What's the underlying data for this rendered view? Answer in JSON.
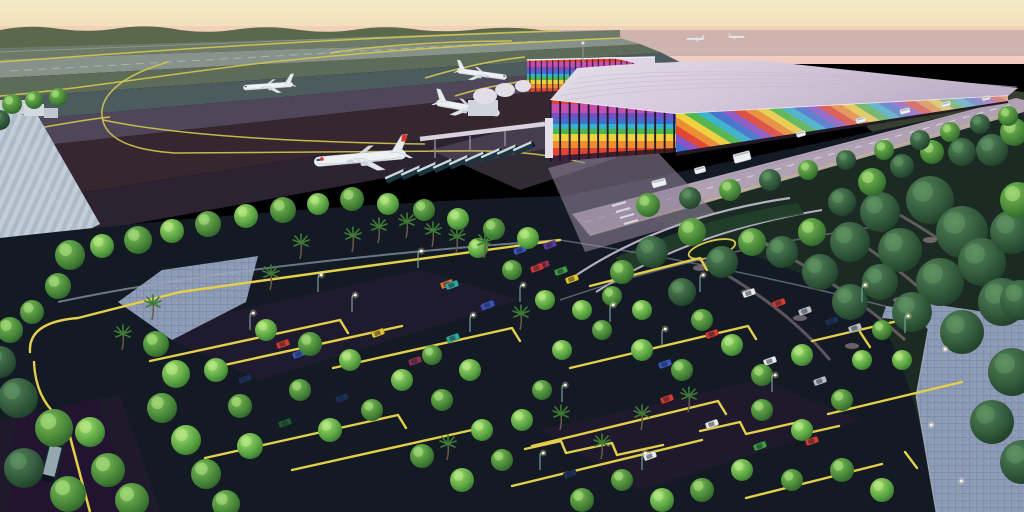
{
  "meta": {
    "title": "Aerial rendering of a tropical airport terminal at sunset",
    "description": "3D architectural rendering: rainbow-striped airport terminal with lavender roof, white jets on taxiways with yellow guide lines, bus queue, landscaped parking lot with yellow curbs, green trees, palm trees, street lamps and paver walkways under a peach sunset sky.",
    "type": "architectural-rendering"
  },
  "palette": {
    "sky_top": "#f2ecc6",
    "sky_mid": "#f6dcba",
    "sky_low": "#f0cbc2",
    "treeline": "#5a684c",
    "haze": "#9a8d9c",
    "tarmac_light": "#87928a",
    "tarmac_green": "#5d6b59",
    "tarmac_teal": "#4c5b5e",
    "tarmac_purple": "#4f4759",
    "tarmac_maroon": "#362630",
    "taxiline": "#d4c94f",
    "curb_yellow": "#e3cf4b",
    "roof": "#d6cbda",
    "roof_rib": "#c7bacd",
    "rainbow": [
      "#e04434",
      "#ee8c30",
      "#eed23c",
      "#4db648",
      "#35b2cc",
      "#3f6fd0",
      "#8a52c4",
      "#c44fb0"
    ],
    "road": "#b0a2b2",
    "asphalt": "#141a24",
    "paver": "#8e9bb6",
    "grass_island": "#21402a",
    "bus_body": "#1d3540",
    "plane_body": "#eef1f4"
  },
  "scene": {
    "taxiway_lines": [
      "M0,62 C160,50 340,38 560,31",
      "M0,96 C90,88 180,72 280,61 C380,51 480,44 620,38",
      "M168,62 C120,76 100,96 102,116 C104,138 130,150 175,153 L460,151 C520,150 555,156 585,163",
      "M103,120 C170,134 280,142 425,144",
      "M330,53 C380,45 450,41 512,41",
      "M425,78 C465,66 495,60 525,57",
      "M455,96 C480,88 505,84 530,80",
      "M0,135 C40,128 80,120 110,117"
    ],
    "parking_rows": [
      "M30,352 Q28,322 78,318 L180,292 L368,266",
      "M66,422 Q36,404 34,362",
      "M150,361 L340,320 l8,13",
      "M220,366 L402,326",
      "M333,368 L512,328 l8,13",
      "M205,458 L398,415 l8,13",
      "M292,470 L472,430",
      "M590,286 L700,258 l7,12",
      "M570,368 L748,326 l8,13",
      "M532,446 L718,401 l8,13",
      "M512,486 L702,440",
      "M812,341 L902,320",
      "M828,414 L962,382",
      "M746,498 L882,464",
      "M525,449 l36,-8 l5,12 l46,-10 l5,12 l46,-10",
      "M700,431 l40,-9 l6,12 l48,-11 l5,12 l40,-9",
      "M860,332 l10,15",
      "M905,452 l12,16",
      "M368,266 L560,240"
    ],
    "airplanes": [
      {
        "x": 268,
        "y": 86,
        "s": 0.62,
        "r": -4,
        "flip": false,
        "mark": false
      },
      {
        "x": 360,
        "y": 158,
        "s": 1.15,
        "r": -5,
        "flip": false,
        "mark": true
      },
      {
        "x": 468,
        "y": 108,
        "s": 0.8,
        "r": 10,
        "flip": true,
        "mark": false
      },
      {
        "x": 482,
        "y": 74,
        "s": 0.62,
        "r": 8,
        "flip": true,
        "mark": false
      },
      {
        "x": 695,
        "y": 39,
        "s": 0.22,
        "r": 0,
        "flip": false,
        "mark": false
      },
      {
        "x": 737,
        "y": 37,
        "s": 0.2,
        "r": 0,
        "flip": true,
        "mark": false
      }
    ],
    "terminal_buses": {
      "count": 9,
      "start_x": 396,
      "start_y": 176,
      "dx": 16,
      "dy": -3.5,
      "angle": -24
    },
    "road_vehicles": [
      {
        "x": 905,
        "y": 111,
        "w": 10,
        "h": 5
      },
      {
        "x": 946,
        "y": 104,
        "w": 9,
        "h": 4.5
      },
      {
        "x": 986,
        "y": 98,
        "w": 8,
        "h": 4
      },
      {
        "x": 861,
        "y": 120,
        "w": 10,
        "h": 5
      },
      {
        "x": 801,
        "y": 134,
        "w": 9,
        "h": 5
      },
      {
        "x": 742,
        "y": 157,
        "w": 17,
        "h": 9
      },
      {
        "x": 700,
        "y": 170,
        "w": 11,
        "h": 6
      },
      {
        "x": 659,
        "y": 183,
        "w": 14,
        "h": 7
      }
    ],
    "cars": [
      [
        283,
        344,
        "#d23b30"
      ],
      [
        299,
        354,
        "#3b55bd"
      ],
      [
        245,
        379,
        "#1c2f55"
      ],
      [
        378,
        333,
        "#e5c32e"
      ],
      [
        453,
        338,
        "#2fa8a0"
      ],
      [
        415,
        361,
        "#8e2f52"
      ],
      [
        285,
        423,
        "#1f5c33"
      ],
      [
        342,
        398,
        "#1c2f55"
      ],
      [
        447,
        284,
        "#d4762e"
      ],
      [
        487,
        306,
        "#5b3a9e"
      ],
      [
        520,
        250,
        "#3b55bd"
      ],
      [
        550,
        245,
        "#5b3a9e"
      ],
      [
        543,
        265,
        "#8e2f52"
      ],
      [
        561,
        271,
        "#3f9e3f"
      ],
      [
        572,
        279,
        "#e5c32e"
      ],
      [
        452,
        285,
        "#2fa8a0"
      ],
      [
        488,
        305,
        "#3b55bd"
      ],
      [
        749,
        293,
        "#e8eaec"
      ],
      [
        779,
        303,
        "#d23b30"
      ],
      [
        805,
        311,
        "#b9c0c8"
      ],
      [
        832,
        321,
        "#1c2f55"
      ],
      [
        855,
        328,
        "#b9c0c8"
      ],
      [
        712,
        334,
        "#d23b30"
      ],
      [
        665,
        364,
        "#3b55bd"
      ],
      [
        770,
        361,
        "#e8eaec"
      ],
      [
        820,
        381,
        "#b9c0c8"
      ],
      [
        667,
        399,
        "#d23b30"
      ],
      [
        712,
        424,
        "#e8eaec"
      ],
      [
        760,
        446,
        "#3f9e3f"
      ],
      [
        812,
        441,
        "#d23b30"
      ],
      [
        650,
        456,
        "#e8eaec"
      ],
      [
        570,
        474,
        "#1c2f55"
      ],
      [
        537,
        268,
        "#d23b30"
      ]
    ],
    "trees": [
      [
        70,
        255,
        15,
        2
      ],
      [
        102,
        246,
        12,
        1
      ],
      [
        138,
        240,
        14,
        2
      ],
      [
        172,
        231,
        12,
        1
      ],
      [
        208,
        224,
        13,
        2
      ],
      [
        246,
        216,
        12,
        1
      ],
      [
        283,
        210,
        13,
        2
      ],
      [
        318,
        204,
        11,
        1
      ],
      [
        352,
        199,
        12,
        2
      ],
      [
        388,
        204,
        11,
        1
      ],
      [
        424,
        210,
        11,
        2
      ],
      [
        458,
        219,
        11,
        1
      ],
      [
        494,
        229,
        11,
        2
      ],
      [
        528,
        238,
        11,
        1
      ],
      [
        58,
        286,
        13,
        2
      ],
      [
        32,
        312,
        12,
        2
      ],
      [
        18,
        398,
        20,
        3
      ],
      [
        54,
        428,
        19,
        2
      ],
      [
        24,
        468,
        20,
        3
      ],
      [
        68,
        494,
        18,
        2
      ],
      [
        108,
        470,
        17,
        2
      ],
      [
        90,
        432,
        15,
        1
      ],
      [
        132,
        500,
        17,
        2
      ],
      [
        0,
        362,
        16,
        3
      ],
      [
        10,
        330,
        13,
        2
      ],
      [
        156,
        344,
        13,
        2
      ],
      [
        176,
        374,
        14,
        1
      ],
      [
        162,
        408,
        15,
        2
      ],
      [
        186,
        440,
        15,
        1
      ],
      [
        206,
        474,
        15,
        2
      ],
      [
        226,
        504,
        14,
        2
      ],
      [
        250,
        446,
        13,
        1
      ],
      [
        240,
        406,
        12,
        2
      ],
      [
        216,
        370,
        12,
        1
      ],
      [
        266,
        330,
        11,
        1
      ],
      [
        310,
        344,
        12,
        2
      ],
      [
        350,
        360,
        11,
        1
      ],
      [
        300,
        390,
        11,
        2
      ],
      [
        330,
        430,
        12,
        1
      ],
      [
        372,
        410,
        11,
        2
      ],
      [
        402,
        380,
        11,
        1
      ],
      [
        432,
        355,
        10,
        2
      ],
      [
        470,
        370,
        11,
        1
      ],
      [
        442,
        400,
        11,
        2
      ],
      [
        482,
        430,
        11,
        1
      ],
      [
        422,
        456,
        12,
        2
      ],
      [
        462,
        480,
        12,
        1
      ],
      [
        502,
        460,
        11,
        2
      ],
      [
        522,
        420,
        11,
        1
      ],
      [
        542,
        390,
        10,
        2
      ],
      [
        562,
        350,
        10,
        1
      ],
      [
        602,
        330,
        10,
        2
      ],
      [
        642,
        350,
        11,
        1
      ],
      [
        682,
        370,
        11,
        2
      ],
      [
        642,
        310,
        10,
        1
      ],
      [
        612,
        296,
        10,
        2
      ],
      [
        582,
        310,
        10,
        1
      ],
      [
        702,
        320,
        11,
        2
      ],
      [
        732,
        345,
        11,
        1
      ],
      [
        762,
        375,
        11,
        2
      ],
      [
        802,
        355,
        11,
        1
      ],
      [
        762,
        410,
        11,
        2
      ],
      [
        802,
        430,
        11,
        1
      ],
      [
        842,
        400,
        11,
        2
      ],
      [
        862,
        360,
        10,
        1
      ],
      [
        882,
        330,
        10,
        2
      ],
      [
        902,
        360,
        10,
        1
      ],
      [
        842,
        470,
        12,
        2
      ],
      [
        882,
        490,
        12,
        1
      ],
      [
        792,
        480,
        11,
        2
      ],
      [
        742,
        470,
        11,
        1
      ],
      [
        702,
        490,
        12,
        2
      ],
      [
        662,
        500,
        12,
        1
      ],
      [
        622,
        480,
        11,
        2
      ],
      [
        582,
        500,
        12,
        2
      ],
      [
        545,
        300,
        10,
        1
      ],
      [
        512,
        270,
        10,
        2
      ],
      [
        478,
        248,
        10,
        1
      ],
      [
        930,
        200,
        24,
        3
      ],
      [
        962,
        232,
        26,
        3
      ],
      [
        900,
        250,
        22,
        3
      ],
      [
        940,
        282,
        24,
        3
      ],
      [
        982,
        262,
        24,
        3
      ],
      [
        1012,
        232,
        22,
        3
      ],
      [
        1002,
        302,
        24,
        3
      ],
      [
        962,
        332,
        22,
        3
      ],
      [
        1012,
        372,
        24,
        3
      ],
      [
        992,
        422,
        22,
        3
      ],
      [
        1022,
        462,
        22,
        3
      ],
      [
        880,
        212,
        20,
        3
      ],
      [
        850,
        242,
        20,
        3
      ],
      [
        820,
        272,
        18,
        3
      ],
      [
        850,
        302,
        18,
        3
      ],
      [
        880,
        282,
        18,
        3
      ],
      [
        912,
        312,
        20,
        3
      ],
      [
        652,
        252,
        16,
        3
      ],
      [
        692,
        232,
        14,
        2
      ],
      [
        722,
        262,
        16,
        3
      ],
      [
        752,
        242,
        14,
        2
      ],
      [
        782,
        252,
        16,
        3
      ],
      [
        812,
        232,
        14,
        2
      ],
      [
        842,
        202,
        14,
        3
      ],
      [
        872,
        182,
        14,
        2
      ],
      [
        902,
        166,
        12,
        3
      ],
      [
        932,
        152,
        12,
        2
      ],
      [
        962,
        152,
        14,
        3
      ],
      [
        992,
        150,
        16,
        3
      ],
      [
        1014,
        132,
        14,
        2
      ],
      [
        682,
        292,
        14,
        3
      ],
      [
        622,
        272,
        12,
        2
      ],
      [
        1018,
        200,
        18,
        2
      ],
      [
        1020,
        300,
        20,
        3
      ],
      [
        12,
        104,
        10,
        2
      ],
      [
        34,
        100,
        9,
        2
      ],
      [
        58,
        97,
        9,
        2
      ],
      [
        0,
        120,
        10,
        3
      ],
      [
        648,
        205,
        12,
        2
      ],
      [
        690,
        198,
        11,
        3
      ],
      [
        730,
        190,
        11,
        2
      ],
      [
        770,
        180,
        11,
        3
      ],
      [
        808,
        170,
        10,
        2
      ],
      [
        846,
        160,
        10,
        3
      ],
      [
        884,
        150,
        10,
        2
      ],
      [
        920,
        140,
        10,
        3
      ],
      [
        950,
        132,
        10,
        2
      ],
      [
        980,
        124,
        10,
        3
      ],
      [
        1008,
        116,
        10,
        2
      ]
    ],
    "palms": [
      [
        378,
        243
      ],
      [
        406,
        238
      ],
      [
        432,
        247
      ],
      [
        352,
        252
      ],
      [
        456,
        253
      ],
      [
        484,
        258
      ],
      [
        300,
        259
      ],
      [
        152,
        320
      ],
      [
        122,
        350
      ],
      [
        641,
        430
      ],
      [
        601,
        459
      ],
      [
        447,
        460
      ],
      [
        520,
        330
      ],
      [
        560,
        430
      ],
      [
        688,
        412
      ],
      [
        270,
        290
      ]
    ],
    "lamps": [
      [
        318,
        292
      ],
      [
        418,
        268
      ],
      [
        520,
        302
      ],
      [
        610,
        322
      ],
      [
        700,
        292
      ],
      [
        662,
        346
      ],
      [
        905,
        333
      ],
      [
        772,
        392
      ],
      [
        562,
        402
      ],
      [
        642,
        470
      ],
      [
        942,
        366
      ],
      [
        928,
        442
      ],
      [
        958,
        498
      ],
      [
        862,
        302
      ],
      [
        352,
        312
      ],
      [
        470,
        332
      ],
      [
        250,
        330
      ],
      [
        540,
        470
      ]
    ],
    "pink_paths": [
      "M690,255 Q780,300 830,360",
      "M760,240 Q850,290 905,340",
      "M840,230 Q920,280 960,330",
      "M900,215 Q960,250 1005,290"
    ]
  }
}
